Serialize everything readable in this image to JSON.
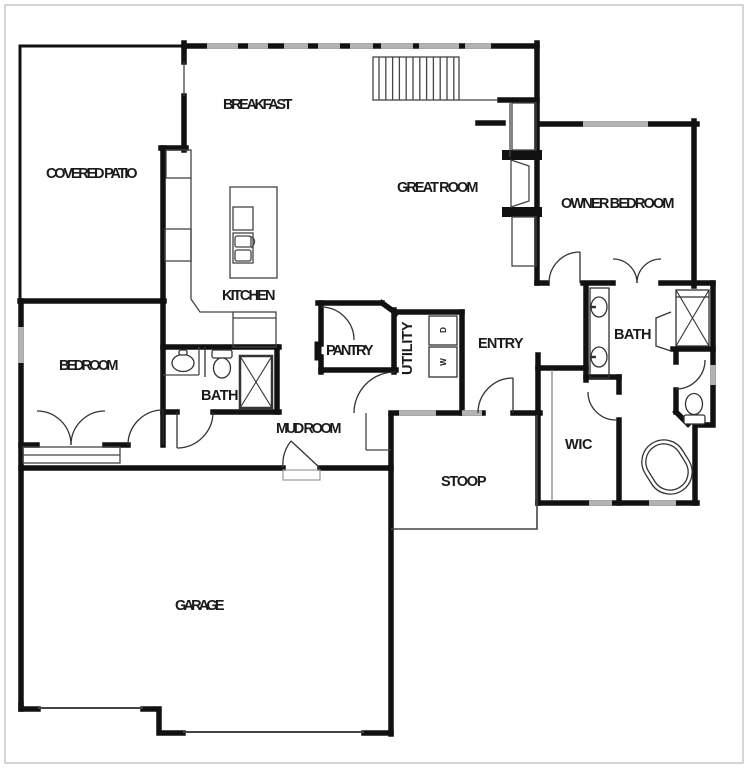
{
  "plan": {
    "background": "#ffffff",
    "wall_color": "#111111",
    "thin_color": "#333333",
    "window_color": "#b3b3b3",
    "frame_color": "#c9c9c9",
    "text_color": "#1a1a1a"
  },
  "rooms": {
    "covered_patio": {
      "label": "COVERED PATIO"
    },
    "breakfast": {
      "label": "BREAKFAST"
    },
    "great_room": {
      "label": "GREAT ROOM"
    },
    "owner_bedroom": {
      "label": "OWNER BEDROOM"
    },
    "kitchen": {
      "label": "KITCHEN"
    },
    "pantry": {
      "label": "PANTRY"
    },
    "utility": {
      "label": "UTILITY"
    },
    "entry": {
      "label": "ENTRY"
    },
    "hall_bath": {
      "label": "BATH"
    },
    "owner_bath": {
      "label": "BATH"
    },
    "bedroom": {
      "label": "BEDROOM"
    },
    "mud_room": {
      "label": "MUD ROOM"
    },
    "wic": {
      "label": "WIC"
    },
    "stoop": {
      "label": "STOOP"
    },
    "garage": {
      "label": "GARAGE"
    }
  },
  "appliances": {
    "washer": "W",
    "dryer": "D"
  }
}
